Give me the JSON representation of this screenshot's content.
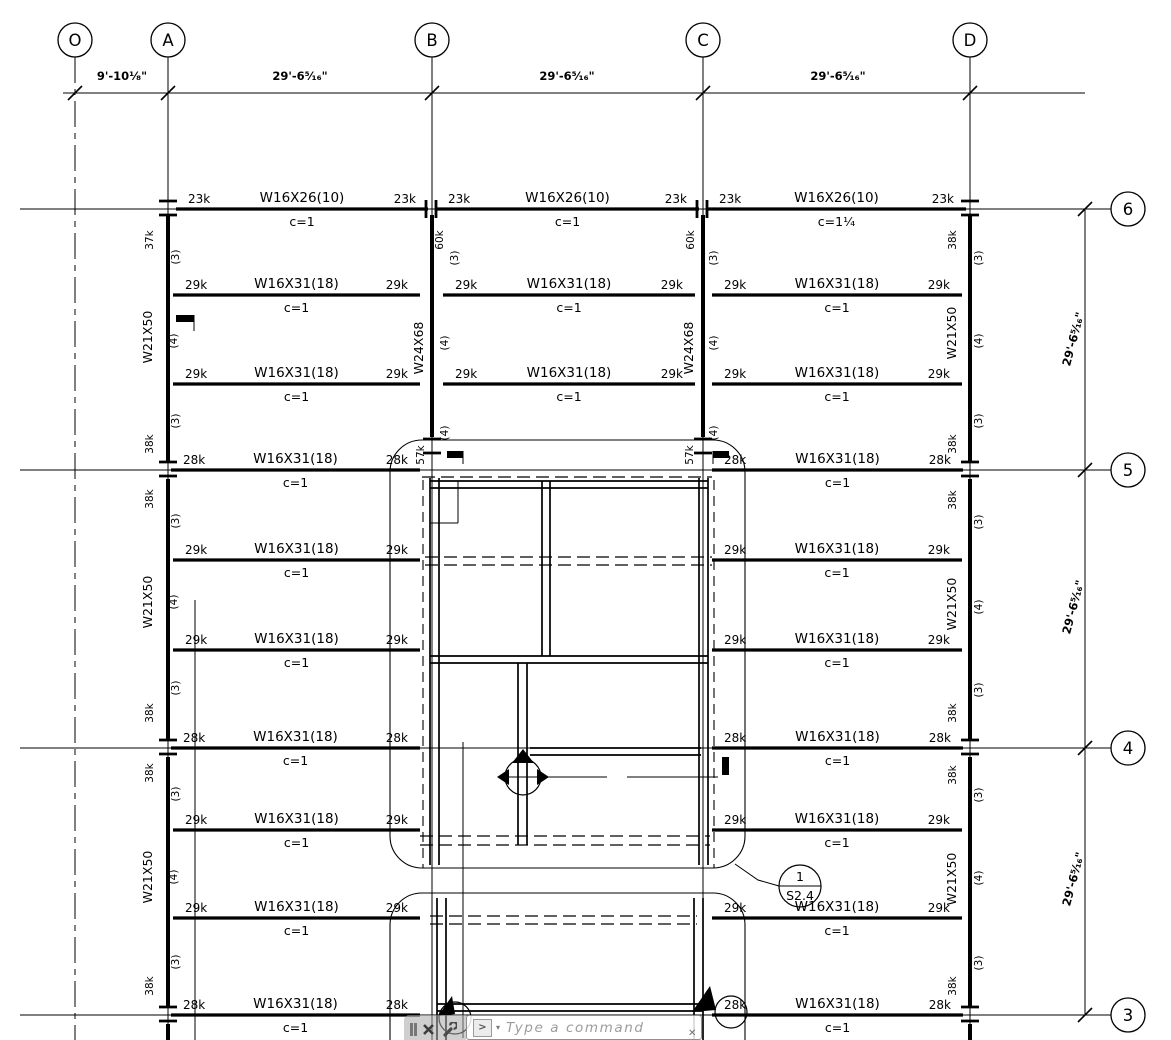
{
  "command_bar": {
    "placeholder": "Type a command",
    "close_glyph": "✕",
    "prompt_glyph": ">",
    "dropdown_glyph": "▾",
    "stray_glyph": "✕"
  },
  "plan": {
    "colors": {
      "ink": "#000000"
    },
    "grid": {
      "columns": [
        {
          "label": "O",
          "x": 75,
          "style": "center"
        },
        {
          "label": "A",
          "x": 168
        },
        {
          "label": "B",
          "x": 432
        },
        {
          "label": "C",
          "x": 703
        },
        {
          "label": "D",
          "x": 970
        }
      ],
      "rows": [
        {
          "label": "6",
          "y": 209
        },
        {
          "label": "5",
          "y": 470
        },
        {
          "label": "4",
          "y": 748
        },
        {
          "label": "3",
          "y": 1015
        }
      ],
      "bubble_radius": 17,
      "top_bubble_y": 40,
      "right_bubble_x": 1128,
      "top_dim_y": 93,
      "right_dim_x": 1085
    },
    "dims_top": [
      {
        "text": "9'-10 1/8\"",
        "x": 122
      },
      {
        "text": "29'-6 5/16\"",
        "x": 300
      },
      {
        "text": "29'-6 5/16\"",
        "x": 567
      },
      {
        "text": "29'-6 5/16\"",
        "x": 838
      }
    ],
    "dims_right": [
      {
        "text": "29'-6 5/16\"",
        "y": 340
      },
      {
        "text": "29'-6 5/16\"",
        "y": 608
      },
      {
        "text": "29'-6 5/16\"",
        "y": 880
      }
    ],
    "beams": [
      {
        "y": 209,
        "x1": 176,
        "x2": 428,
        "size": "W16X26(10)",
        "left": "23k",
        "right": "23k",
        "c": "c=1"
      },
      {
        "y": 209,
        "x1": 436,
        "x2": 699,
        "size": "W16X26(10)",
        "left": "23k",
        "right": "23k",
        "c": "c=1"
      },
      {
        "y": 209,
        "x1": 707,
        "x2": 966,
        "size": "W16X26(10)",
        "left": "23k",
        "right": "23k",
        "c": "c=1 1/4"
      },
      {
        "y": 295,
        "x1": 173,
        "x2": 420,
        "size": "W16X31(18)",
        "left": "29k",
        "right": "29k",
        "c": "c=1"
      },
      {
        "y": 295,
        "x1": 443,
        "x2": 695,
        "size": "W16X31(18)",
        "left": "29k",
        "right": "29k",
        "c": "c=1"
      },
      {
        "y": 295,
        "x1": 712,
        "x2": 962,
        "size": "W16X31(18)",
        "left": "29k",
        "right": "29k",
        "c": "c=1"
      },
      {
        "y": 384,
        "x1": 173,
        "x2": 420,
        "size": "W16X31(18)",
        "left": "29k",
        "right": "29k",
        "c": "c=1"
      },
      {
        "y": 384,
        "x1": 443,
        "x2": 695,
        "size": "W16X31(18)",
        "left": "29k",
        "right": "29k",
        "c": "c=1"
      },
      {
        "y": 384,
        "x1": 712,
        "x2": 962,
        "size": "W16X31(18)",
        "left": "29k",
        "right": "29k",
        "c": "c=1"
      },
      {
        "y": 470,
        "x1": 171,
        "x2": 420,
        "size": "W16X31(18)",
        "left": "28k",
        "right": "28k",
        "c": "c=1"
      },
      {
        "y": 470,
        "x1": 712,
        "x2": 963,
        "size": "W16X31(18)",
        "left": "28k",
        "right": "28k",
        "c": "c=1"
      },
      {
        "y": 560,
        "x1": 173,
        "x2": 420,
        "size": "W16X31(18)",
        "left": "29k",
        "right": "29k",
        "c": "c=1"
      },
      {
        "y": 560,
        "x1": 712,
        "x2": 962,
        "size": "W16X31(18)",
        "left": "29k",
        "right": "29k",
        "c": "c=1"
      },
      {
        "y": 650,
        "x1": 173,
        "x2": 420,
        "size": "W16X31(18)",
        "left": "29k",
        "right": "29k",
        "c": "c=1"
      },
      {
        "y": 650,
        "x1": 712,
        "x2": 962,
        "size": "W16X31(18)",
        "left": "29k",
        "right": "29k",
        "c": "c=1"
      },
      {
        "y": 748,
        "x1": 171,
        "x2": 420,
        "size": "W16X31(18)",
        "left": "28k",
        "right": "28k",
        "c": "c=1"
      },
      {
        "y": 748,
        "x1": 712,
        "x2": 963,
        "size": "W16X31(18)",
        "left": "28k",
        "right": "28k",
        "c": "c=1"
      },
      {
        "y": 830,
        "x1": 173,
        "x2": 420,
        "size": "W16X31(18)",
        "left": "29k",
        "right": "29k",
        "c": "c=1"
      },
      {
        "y": 830,
        "x1": 712,
        "x2": 962,
        "size": "W16X31(18)",
        "left": "29k",
        "right": "29k",
        "c": "c=1"
      },
      {
        "y": 918,
        "x1": 173,
        "x2": 420,
        "size": "W16X31(18)",
        "left": "29k",
        "right": "29k",
        "c": "c=1"
      },
      {
        "y": 918,
        "x1": 712,
        "x2": 962,
        "size": "W16X31(18)",
        "left": "29k",
        "right": "29k",
        "c": "c=1"
      },
      {
        "y": 1015,
        "x1": 171,
        "x2": 420,
        "size": "W16X31(18)",
        "left": "28k",
        "right": "28k",
        "c": "c=1"
      },
      {
        "y": 1015,
        "x1": 712,
        "x2": 963,
        "size": "W16X31(18)",
        "left": "28k",
        "right": "28k",
        "c": "c=1"
      }
    ],
    "girders": [
      {
        "x": 168,
        "y1": 215,
        "y2": 461
      },
      {
        "x": 168,
        "y1": 479,
        "y2": 739
      },
      {
        "x": 168,
        "y1": 757,
        "y2": 1006
      },
      {
        "x": 168,
        "y1": 1024,
        "y2": 1040
      },
      {
        "x": 432,
        "y1": 215,
        "y2": 437
      },
      {
        "x": 703,
        "y1": 215,
        "y2": 437
      },
      {
        "x": 970,
        "y1": 215,
        "y2": 461
      },
      {
        "x": 970,
        "y1": 479,
        "y2": 739
      },
      {
        "x": 970,
        "y1": 757,
        "y2": 1006
      },
      {
        "x": 970,
        "y1": 1024,
        "y2": 1040
      }
    ],
    "col_texts": [
      {
        "x": 152,
        "y": 337,
        "t": "W21X50"
      },
      {
        "x": 152,
        "y": 602,
        "t": "W21X50"
      },
      {
        "x": 152,
        "y": 877,
        "t": "W21X50"
      },
      {
        "x": 423,
        "y": 348,
        "t": "W24X68"
      },
      {
        "x": 693,
        "y": 348,
        "t": "W24X68"
      },
      {
        "x": 956,
        "y": 333,
        "t": "W21X50"
      },
      {
        "x": 956,
        "y": 604,
        "t": "W21X50"
      },
      {
        "x": 956,
        "y": 879,
        "t": "W21X50"
      }
    ],
    "side_texts": [
      {
        "x": 153,
        "y": 240,
        "t": "37k"
      },
      {
        "x": 179,
        "y": 257,
        "t": "(3)"
      },
      {
        "x": 177,
        "y": 341,
        "t": "(4)"
      },
      {
        "x": 179,
        "y": 421,
        "t": "(3)"
      },
      {
        "x": 153,
        "y": 444,
        "t": "38k"
      },
      {
        "x": 153,
        "y": 499,
        "t": "38k"
      },
      {
        "x": 179,
        "y": 521,
        "t": "(3)"
      },
      {
        "x": 177,
        "y": 602,
        "t": "(4)"
      },
      {
        "x": 179,
        "y": 688,
        "t": "(3)"
      },
      {
        "x": 153,
        "y": 713,
        "t": "38k"
      },
      {
        "x": 153,
        "y": 773,
        "t": "38k"
      },
      {
        "x": 179,
        "y": 794,
        "t": "(3)"
      },
      {
        "x": 177,
        "y": 877,
        "t": "(4)"
      },
      {
        "x": 179,
        "y": 962,
        "t": "(3)"
      },
      {
        "x": 153,
        "y": 986,
        "t": "38k"
      },
      {
        "x": 443,
        "y": 240,
        "t": "60k"
      },
      {
        "x": 458,
        "y": 258,
        "t": "(3)"
      },
      {
        "x": 448,
        "y": 343,
        "t": "(4)"
      },
      {
        "x": 448,
        "y": 433,
        "t": "(4)"
      },
      {
        "x": 424,
        "y": 455,
        "t": "57k"
      },
      {
        "x": 694,
        "y": 240,
        "t": "60k"
      },
      {
        "x": 717,
        "y": 258,
        "t": "(3)"
      },
      {
        "x": 717,
        "y": 343,
        "t": "(4)"
      },
      {
        "x": 717,
        "y": 433,
        "t": "(4)"
      },
      {
        "x": 693,
        "y": 455,
        "t": "57k"
      },
      {
        "x": 956,
        "y": 240,
        "t": "38k"
      },
      {
        "x": 982,
        "y": 258,
        "t": "(3)"
      },
      {
        "x": 982,
        "y": 341,
        "t": "(4)"
      },
      {
        "x": 982,
        "y": 421,
        "t": "(3)"
      },
      {
        "x": 956,
        "y": 444,
        "t": "38k"
      },
      {
        "x": 956,
        "y": 500,
        "t": "38k"
      },
      {
        "x": 982,
        "y": 522,
        "t": "(3)"
      },
      {
        "x": 982,
        "y": 607,
        "t": "(4)"
      },
      {
        "x": 982,
        "y": 690,
        "t": "(3)"
      },
      {
        "x": 956,
        "y": 713,
        "t": "38k"
      },
      {
        "x": 956,
        "y": 775,
        "t": "38k"
      },
      {
        "x": 982,
        "y": 795,
        "t": "(3)"
      },
      {
        "x": 982,
        "y": 878,
        "t": "(4)"
      },
      {
        "x": 982,
        "y": 963,
        "t": "(3)"
      },
      {
        "x": 956,
        "y": 986,
        "t": "38k"
      }
    ],
    "regions": [
      {
        "x": 390,
        "y": 440,
        "w": 355,
        "h": 428,
        "r": 32
      },
      {
        "x": 390,
        "y": 893,
        "w": 355,
        "h": 185,
        "r": 32
      }
    ],
    "walls": [
      [
        430,
        478,
        430,
        865
      ],
      [
        439,
        478,
        439,
        865
      ],
      [
        699,
        478,
        699,
        865
      ],
      [
        708,
        478,
        708,
        865
      ],
      [
        430,
        481,
        708,
        481
      ],
      [
        430,
        488,
        708,
        488
      ],
      [
        542,
        481,
        542,
        656
      ],
      [
        550,
        481,
        550,
        656
      ],
      [
        430,
        656,
        708,
        656
      ],
      [
        430,
        663,
        708,
        663
      ],
      [
        518,
        663,
        518,
        845
      ],
      [
        527,
        663,
        527,
        845
      ],
      [
        530,
        748,
        701,
        748
      ],
      [
        530,
        755,
        701,
        755
      ],
      [
        437,
        898,
        437,
        1040
      ],
      [
        446,
        898,
        446,
        1040
      ],
      [
        694,
        898,
        694,
        1040
      ],
      [
        703,
        898,
        703,
        1040
      ],
      [
        437,
        1004,
        703,
        1004
      ],
      [
        437,
        1011,
        703,
        1011
      ]
    ],
    "dashes": [
      [
        422,
        477,
        712,
        477
      ],
      [
        425,
        557,
        712,
        557
      ],
      [
        425,
        565,
        712,
        565
      ],
      [
        420,
        836,
        710,
        836
      ],
      [
        420,
        845,
        710,
        845
      ],
      [
        430,
        916,
        697,
        916
      ],
      [
        430,
        924,
        697,
        924
      ]
    ],
    "vdashes": [
      [
        423,
        480,
        423,
        868
      ],
      [
        714,
        480,
        714,
        868
      ]
    ],
    "thins": [
      [
        195,
        600,
        195,
        1040
      ],
      [
        463,
        742,
        463,
        1038
      ],
      [
        503,
        777,
        607,
        777
      ],
      [
        627,
        777,
        718,
        777
      ],
      [
        458,
        481,
        458,
        523
      ],
      [
        430,
        523,
        458,
        523
      ],
      [
        194,
        315,
        194,
        331
      ],
      [
        463,
        451,
        463,
        464
      ],
      [
        713,
        451,
        713,
        464
      ]
    ],
    "flags": [
      {
        "x": 176,
        "y": 315,
        "w": 18,
        "h": 7
      },
      {
        "x": 447,
        "y": 451,
        "w": 16,
        "h": 7
      },
      {
        "x": 713,
        "y": 451,
        "w": 16,
        "h": 7
      },
      {
        "x": 722,
        "y": 757,
        "w": 7,
        "h": 18
      }
    ],
    "fan": {
      "cx": 523,
      "cy": 777,
      "r": 18,
      "tris": [
        [
          523,
          749,
          512,
          763,
          534,
          763
        ],
        [
          497,
          777,
          509,
          769,
          509,
          785
        ],
        [
          549,
          777,
          537,
          769,
          537,
          785
        ]
      ]
    },
    "bottom_markers": [
      {
        "cx": 455,
        "cy": 1018,
        "r": 16,
        "tri": [
          452,
          996,
          438,
          1016,
          455,
          1014
        ]
      },
      {
        "cx": 731,
        "cy": 1012,
        "r": 16,
        "tri": [
          710,
          986,
          716,
          1010,
          692,
          1012
        ]
      }
    ],
    "callout": {
      "number": "1",
      "sheet": "S2.4",
      "cx": 800,
      "cy": 886,
      "r": 21,
      "leader": [
        [
          735,
          864
        ],
        [
          758,
          880
        ],
        [
          779,
          886
        ]
      ]
    },
    "splices_h": [
      {
        "x": 168,
        "y": 209
      },
      {
        "x": 168,
        "y": 470
      },
      {
        "x": 168,
        "y": 748
      },
      {
        "x": 168,
        "y": 1015
      },
      {
        "x": 970,
        "y": 209
      },
      {
        "x": 970,
        "y": 470
      },
      {
        "x": 970,
        "y": 748
      },
      {
        "x": 970,
        "y": 1015
      },
      {
        "x": 432,
        "y": 447
      },
      {
        "x": 703,
        "y": 447
      }
    ],
    "splices_v": [
      {
        "x": 432,
        "y": 209
      },
      {
        "x": 703,
        "y": 209
      }
    ]
  }
}
